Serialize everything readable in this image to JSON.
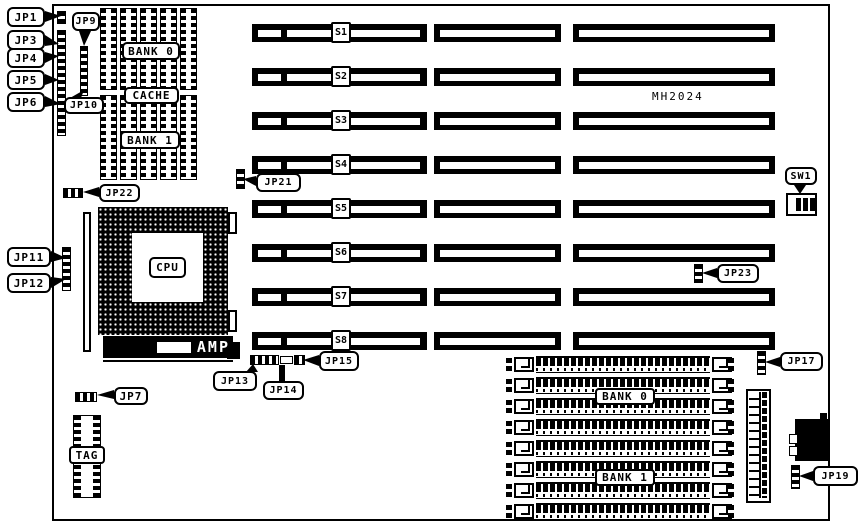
{
  "board": {
    "model": "MH2024"
  },
  "slots": [
    "S1",
    "S2",
    "S3",
    "S4",
    "S5",
    "S6",
    "S7",
    "S8"
  ],
  "cache": {
    "bank0": "BANK 0",
    "cache": "CACHE",
    "bank1": "BANK 1",
    "tag": "TAG"
  },
  "cpu": {
    "label": "CPU",
    "socket_brand": "AMP"
  },
  "memory": {
    "bank0": "BANK 0",
    "bank1": "BANK 1"
  },
  "callouts": {
    "jp1": "JP1",
    "jp3": "JP3",
    "jp4": "JP4",
    "jp5": "JP5",
    "jp6": "JP6",
    "jp7": "JP7",
    "jp9": "JP9",
    "jp10": "JP10",
    "jp11": "JP11",
    "jp12": "JP12",
    "jp13": "JP13",
    "jp14": "JP14",
    "jp15": "JP15",
    "jp17": "JP17",
    "jp19": "JP19",
    "jp21": "JP21",
    "jp22": "JP22",
    "jp23": "JP23",
    "sw1": "SW1"
  },
  "colors": {
    "ink": "#000000",
    "paper": "#ffffff"
  }
}
